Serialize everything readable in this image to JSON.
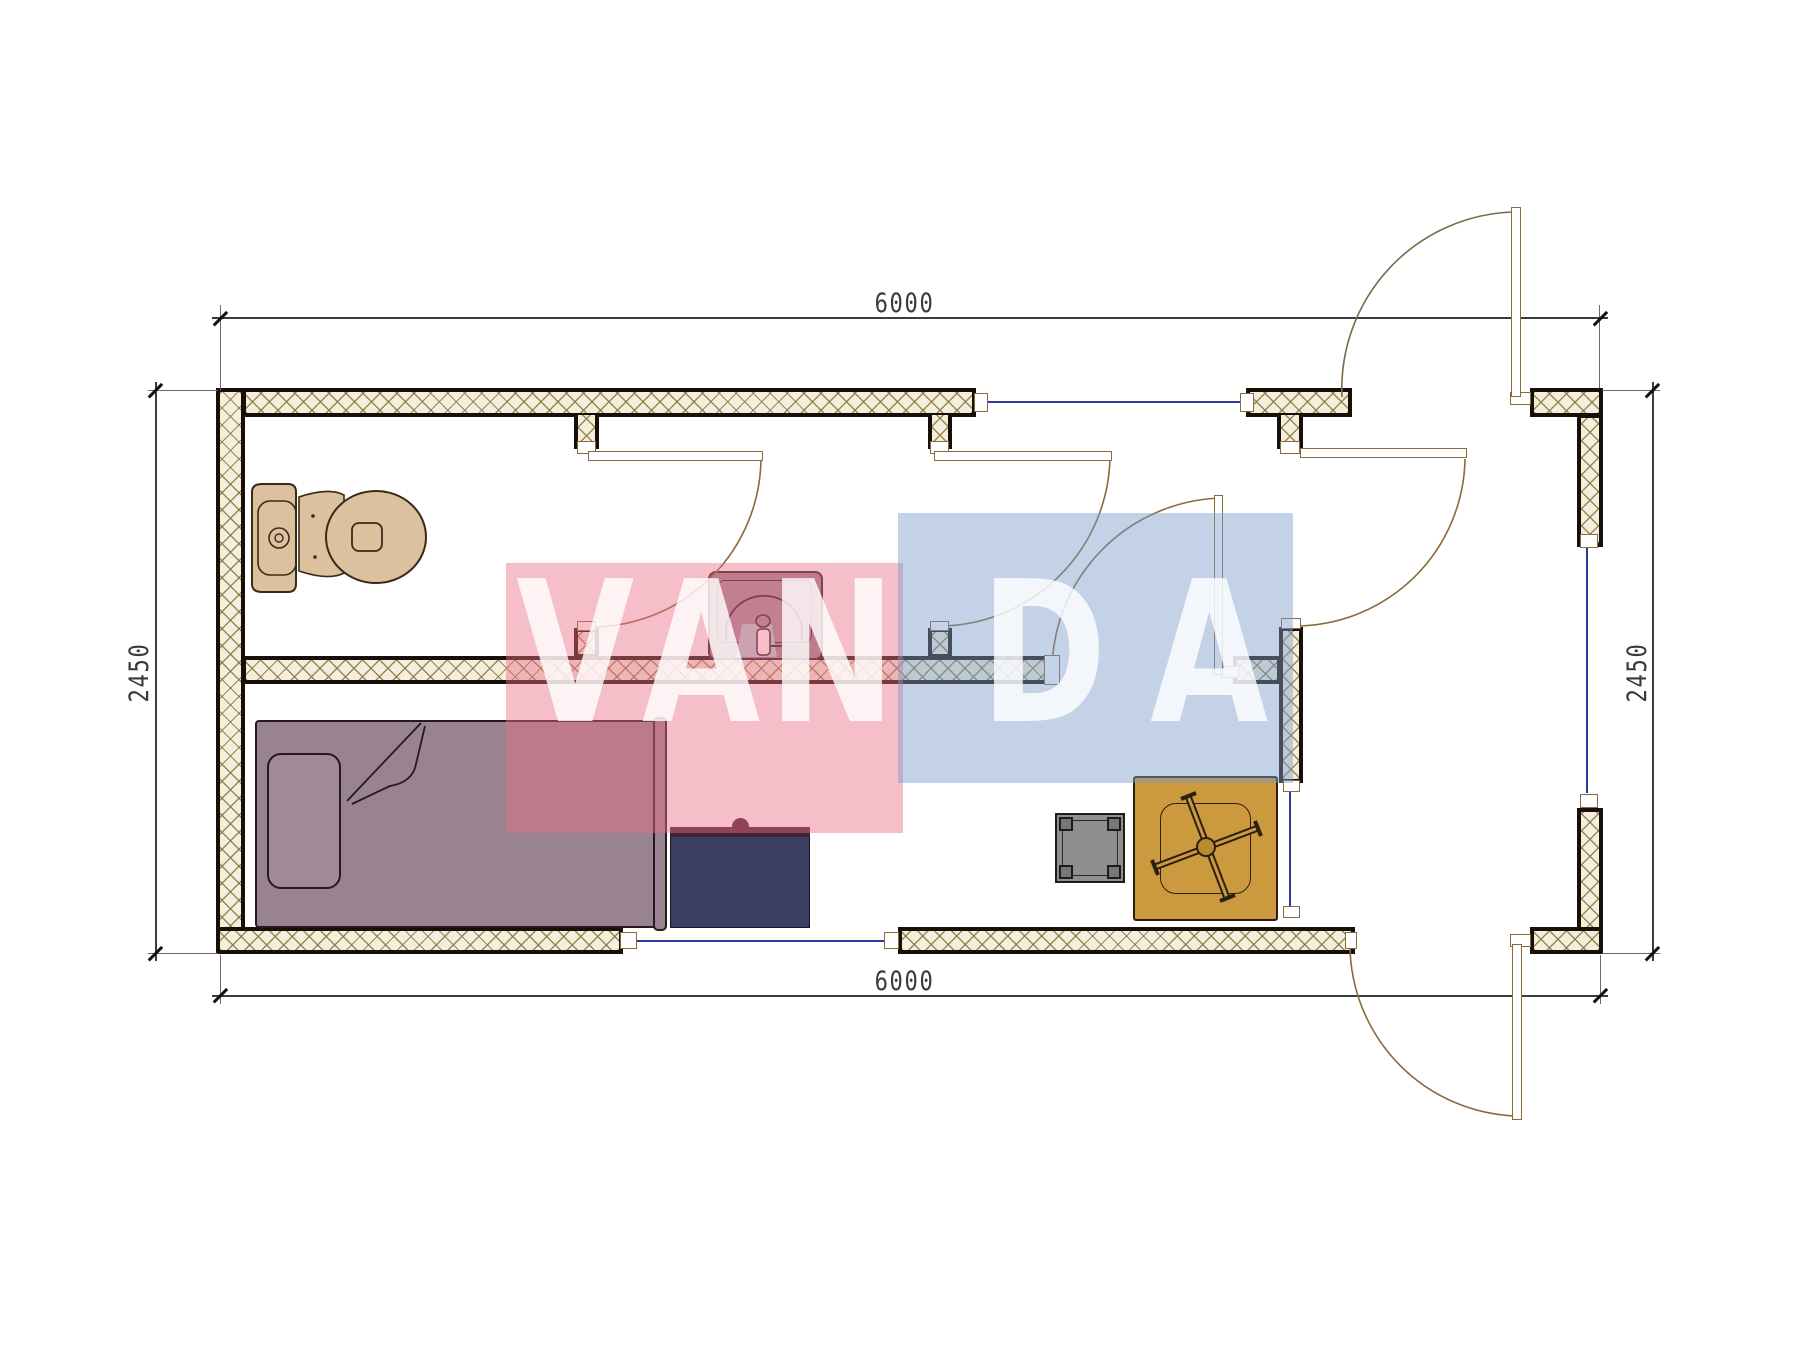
{
  "drawing": {
    "type": "architectural-floor-plan",
    "description": "Single-module cabin plan with toilet room, shower room, hall, entrance room and living/sleeping room",
    "dimensions": {
      "top": "6000",
      "bottom": "6000",
      "left": "2450",
      "right": "2450"
    },
    "fixtures": [
      "toilet",
      "washbasin",
      "bed",
      "desk",
      "stool",
      "table"
    ],
    "doors": [
      "toilet-room-door",
      "shower-room-door",
      "living-room-door",
      "hall-door",
      "top-entrance-door",
      "bottom-entrance-door"
    ],
    "windows": [
      "top-window",
      "right-window",
      "bottom-window",
      "interior-glazed-panel"
    ]
  },
  "watermark": {
    "letters": {
      "l0": "V",
      "l1": "A",
      "l2": "N",
      "l3": "D",
      "l4": "A"
    },
    "pink": "#e96f88",
    "blue": "#7b9cc7",
    "letter_color": "#ffffff"
  },
  "colors": {
    "wall_hatch_line": "#8d7340",
    "wall_fill": "#f4eedd",
    "wall_edge": "#181008",
    "window_glass": "#2e3a9a",
    "door_line": "#8a6a3c",
    "toilet": "#dcc19e",
    "bed": "#9a8391",
    "desk": "#3b3f63",
    "desk_top": "#452138",
    "stool": "#8f8f8f",
    "table": "#cc9a3e",
    "sink_body": "#9c8793",
    "sink_teal": "#b3cdd1",
    "dimension": "#3a3a3a"
  }
}
